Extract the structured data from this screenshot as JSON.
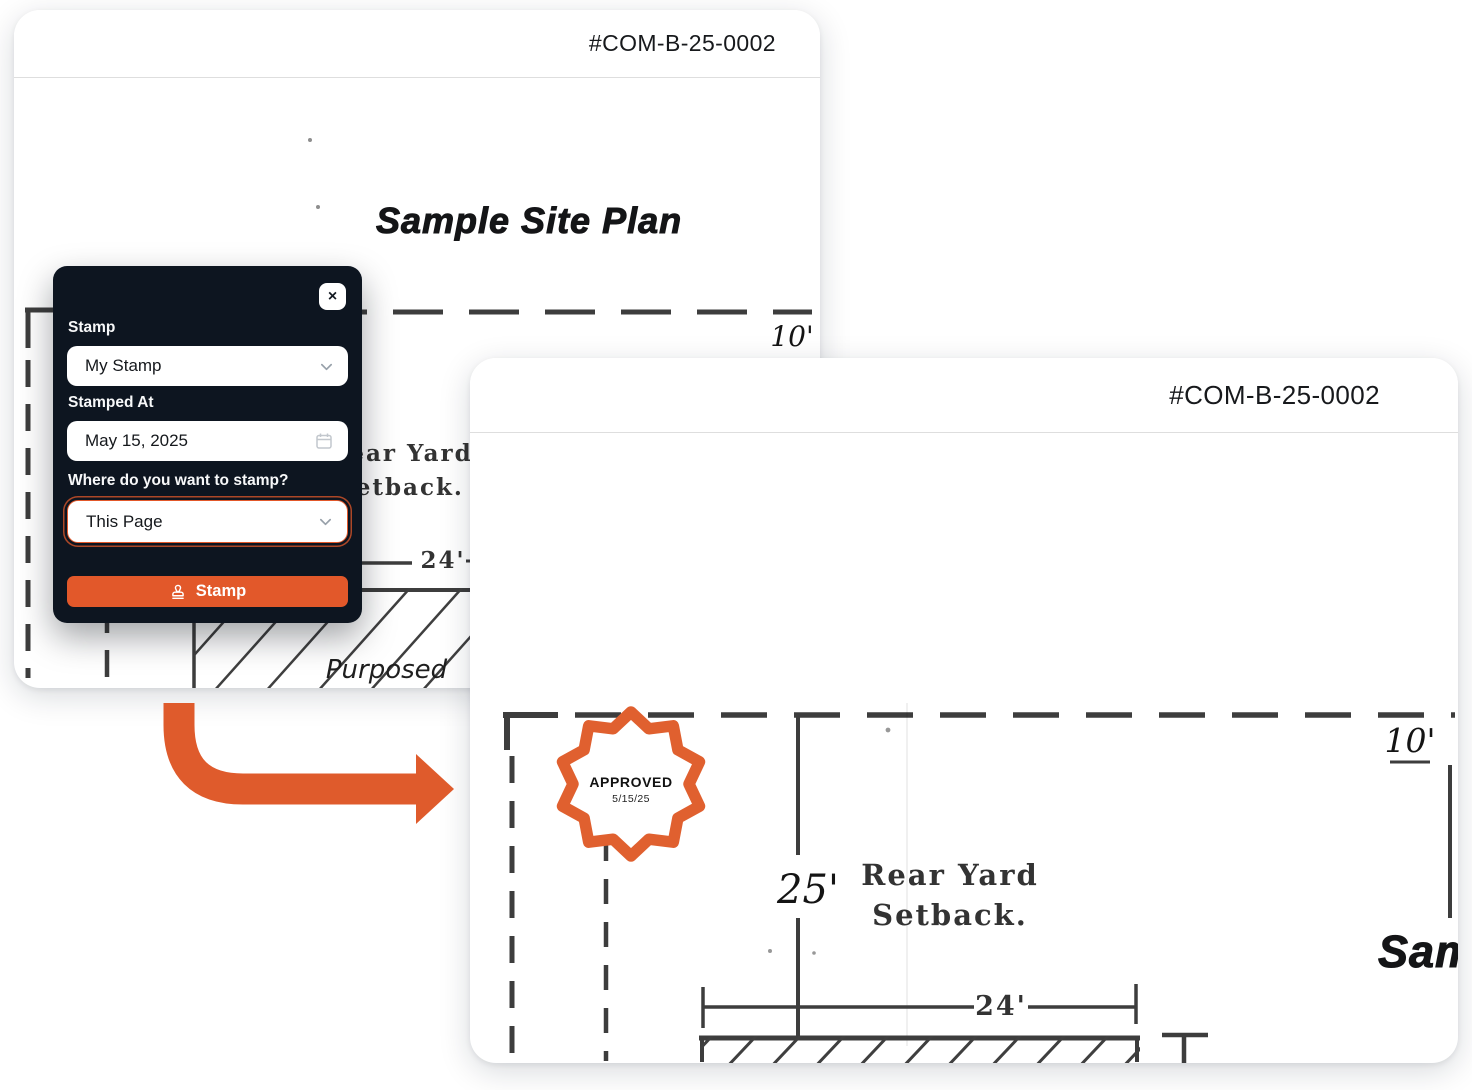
{
  "colors": {
    "brand_orange": "#E2582A",
    "seal_orange": "#E0602F",
    "arrow_orange": "#DF5B2C",
    "modal_bg": "#0D1520",
    "plan_ink": "#3D3D3D"
  },
  "panel_before": {
    "doc_id": "#COM-B-25-0002",
    "title": "Sample Site Plan",
    "plan": {
      "dim_10": "10'",
      "rear_yard": "Rear Yard",
      "setback": "Setback.",
      "dim_24": "24'",
      "purposed": "Purposed"
    }
  },
  "modal": {
    "close_label": "×",
    "stamp_label": "Stamp",
    "stamp_value": "My Stamp",
    "stamped_at_label": "Stamped At",
    "stamped_at_value": "May 15, 2025",
    "where_label": "Where do you want to stamp?",
    "where_value": "This Page",
    "submit_label": "Stamp"
  },
  "panel_after": {
    "doc_id": "#COM-B-25-0002",
    "title": "Sample Site Plan",
    "plan": {
      "dim_10": "10'",
      "dim_25": "25'",
      "rear_yard": "Rear Yard",
      "setback": "Setback.",
      "dim_24": "24'"
    },
    "seal": {
      "line1": "APPROVED",
      "line2": "5/15/25"
    }
  }
}
